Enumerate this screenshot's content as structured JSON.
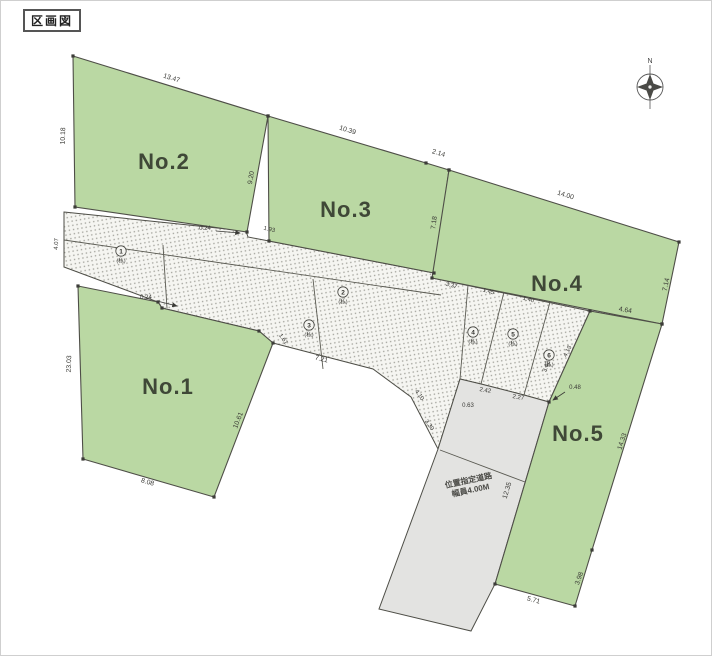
{
  "page": {
    "title_box": "区画図"
  },
  "compass": {
    "north_label": "N"
  },
  "colors": {
    "lot_green": "#bad8a3",
    "road_gray": "#e3e3e1",
    "hatch_dot": "#a2a29b",
    "outline": "#4e4e47"
  },
  "lots": [
    {
      "name": "No.1"
    },
    {
      "name": "No.2"
    },
    {
      "name": "No.3"
    },
    {
      "name": "No.4"
    },
    {
      "name": "No.5"
    }
  ],
  "gray_road": {
    "line1": "位置指定道路",
    "line2": "幅員4.00M"
  },
  "parcel_marks": [
    {
      "num": "1",
      "note": "(私)"
    },
    {
      "num": "2",
      "note": "(私)"
    },
    {
      "num": "3",
      "note": "(私)"
    },
    {
      "num": "4",
      "note": "(私)"
    },
    {
      "num": "5",
      "note": "(私)"
    },
    {
      "num": "6",
      "note": "(私)"
    }
  ],
  "dimensions": {
    "no2_top": "13.47",
    "no2_left": "10.18",
    "no2_right": "9.20",
    "no3_top": "10.39",
    "no3_top_small": "2.14",
    "no3_right": "7.18",
    "no4_top": "14.00",
    "no4_right": "7.14",
    "no5_top": "4.64",
    "no5_right": "14.33",
    "no5_lower_right": "3.98",
    "no5_bottom": "5.71",
    "no5_left": "12.35",
    "no1_left": "23.03",
    "no1_bottom": "8.08",
    "no1_right": "10.61",
    "no1_top_right": "1.61",
    "jog_top": "0.24",
    "gap_top": "1.93",
    "jog_bottom": "0.24",
    "band_bottom": "7.21",
    "band_right_upper": "4.10",
    "band_right_lower": "3.30",
    "gray_top": "0.63",
    "fan_b1": "2.42",
    "fan_b2": "2.27",
    "fan_offset": "0.48",
    "fan_edge": "3.42",
    "fan_edge_right": "4.13",
    "wedge_t1": "3.37",
    "wedge_t2": "1.45",
    "wedge_t3": "1.40",
    "left_edge": "4.07"
  }
}
